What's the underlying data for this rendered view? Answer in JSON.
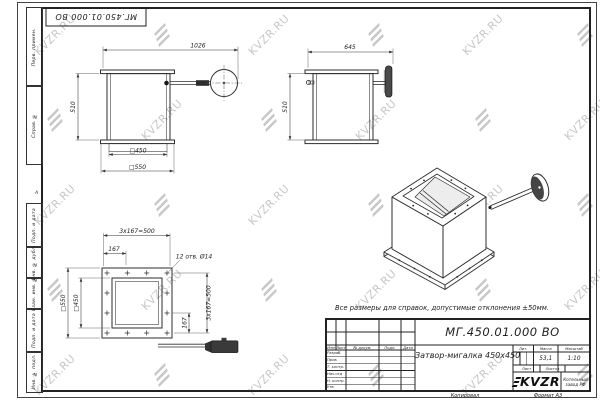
{
  "sheet": {
    "note": "Все размеры для справок, допустимые отклонения ±50мм.",
    "copied_label": "Копировал",
    "format_label": "Формат А3",
    "zone_marker": "А",
    "watermark_text": "KVZR.RU",
    "watermark_color": "#c7c7c7"
  },
  "corner_stamp": {
    "designation": "МГ.450.01.000 ВО"
  },
  "margin": {
    "top": [
      "Перв. примен.",
      "Справ. №"
    ],
    "bottom": [
      "Подп. и дата",
      "Инв. № дубл.",
      "Взам. инв. №",
      "Подп. и дата",
      "Инв. № подл."
    ]
  },
  "title_block": {
    "designation": "МГ.450.01.000 ВО",
    "name": "Затвор-мигалка 450x450",
    "mass_value": "53,1",
    "scale_value": "1:10",
    "col_headers": {
      "izm": "Изм",
      "list": "Лист",
      "doc": "№ докум.",
      "sign": "Подп.",
      "date": "Дата"
    },
    "cell_headers": {
      "lit": "Лит.",
      "mass": "Масса",
      "scale": "Масштаб",
      "sheet": "Лист",
      "sheets": "Листов"
    },
    "roles": [
      "Разраб.",
      "Пров.",
      "Т. контр.",
      "Нач.отд",
      "Н. контр.",
      "Утв."
    ],
    "company": {
      "logo_text": "KVZR",
      "name_line1": "Котельный",
      "name_line2": "завод РФ"
    }
  },
  "views": {
    "front": {
      "overall_width": "1026",
      "height": "510",
      "inner_square": "□450",
      "outer_square": "□550"
    },
    "side": {
      "overall_width": "645",
      "height": "510"
    },
    "plan": {
      "pitch_top": "3x167=500",
      "offset_top": "167",
      "holes_note": "12 отв. Ø14",
      "outer_square": "□550",
      "inner_square": "□450",
      "pitch_right": "3x167=500",
      "offset_right": "167"
    }
  }
}
